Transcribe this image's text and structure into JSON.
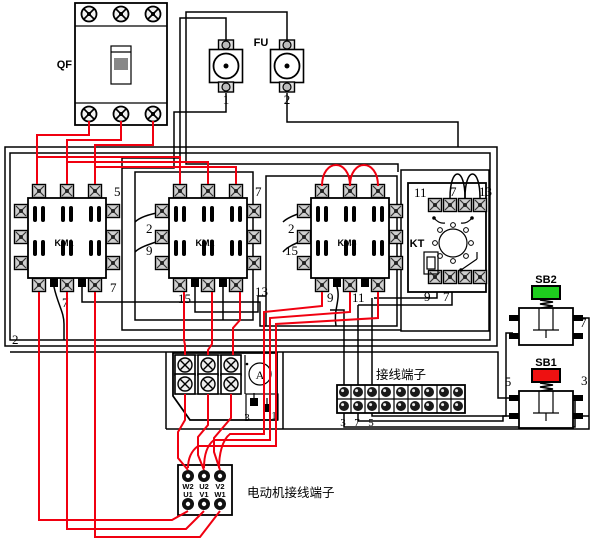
{
  "colors": {
    "power_wire": "#f00010",
    "control_wire": "#000000",
    "sb1_cap": "#ee1111",
    "sb2_cap": "#1ecc1e"
  },
  "breaker_qf": {
    "label": "QF"
  },
  "fuses": {
    "label": "FU",
    "fuse1": "1",
    "fuse2": "2"
  },
  "contactors": {
    "km1": {
      "label": "KM1",
      "wire_top_right": "5",
      "wire_bottom_right": "7",
      "wire_bottom_mid": "7",
      "wire_left_bottom": "2"
    },
    "km2": {
      "label": "KM2",
      "wire_left_top": "2",
      "wire_left_mid": "9",
      "wire_top_right": "7",
      "wire_bottom_left": "15",
      "wire_bottom_right": "13"
    },
    "km3": {
      "label": "KM3",
      "wire_left_top": "2",
      "wire_left_mid": "15",
      "wire_bottom_left": "9",
      "wire_bottom_mid": "11"
    }
  },
  "timer_kt": {
    "label": "KT",
    "wire_11": "11",
    "wire_7_top": "7",
    "wire_13": "13",
    "wire_9": "9",
    "wire_7_bottom": "7"
  },
  "buttons": {
    "sb2": {
      "label": "SB2",
      "wire_7": "7",
      "cap_color": "#1ecc1e"
    },
    "sb1": {
      "label": "SB1",
      "wire_5": "5",
      "wire_3": "3",
      "cap_color": "#ee1111"
    }
  },
  "terminal_strip": {
    "label": "接线端子",
    "wire_3": "3",
    "wire_7": "7",
    "wire_5": "5"
  },
  "overload_module": {
    "ammeter": "A",
    "wire_3": "3",
    "wire_1": "1"
  },
  "motor_block": {
    "label": "电动机接线端子",
    "terminals_top": [
      "W2",
      "U2",
      "V2"
    ],
    "terminals_bottom": [
      "U1",
      "V1",
      "W1"
    ]
  }
}
